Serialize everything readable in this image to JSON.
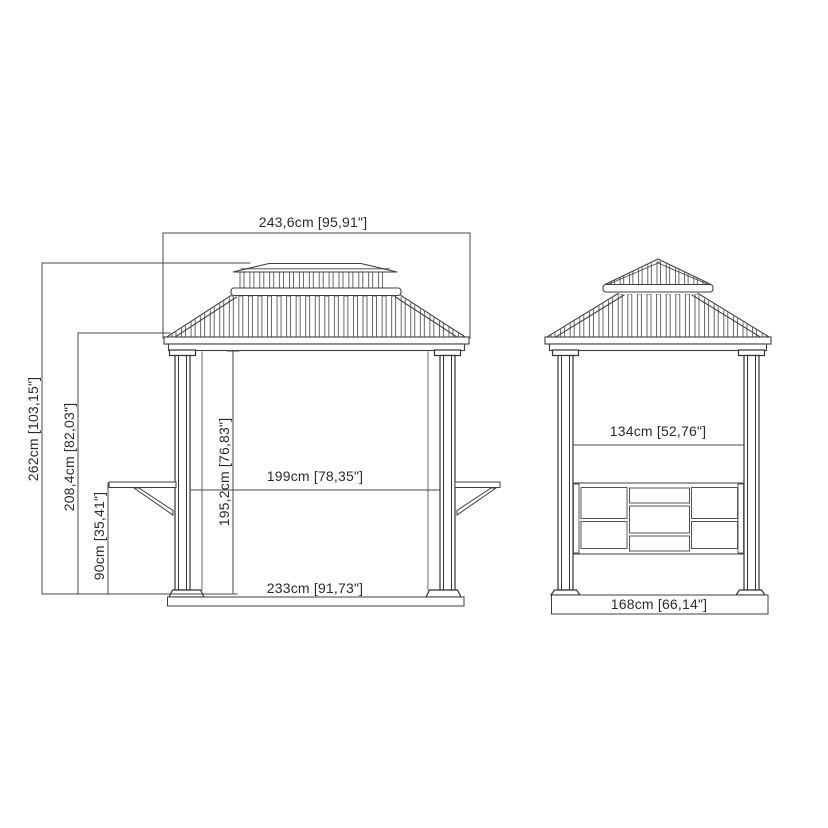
{
  "drawing_meta": {
    "background": "#ffffff",
    "line_color": "#474747",
    "text_color": "#2b2b2b"
  },
  "front_view": {
    "dims": {
      "roof_width": "243,6cm [95,91\"]",
      "total_height": "262cm [103,15\"]",
      "frame_height": "208,4cm [82,03\"]",
      "shelf_height": "90cm [35,41\"]",
      "post_clear_height": "195,2cm [76,83\"]",
      "inner_width": "199cm [78,35\"]",
      "base_width": "233cm [91,73\"]"
    }
  },
  "side_view": {
    "dims": {
      "inner_depth": "134cm [52,76\"]",
      "base_depth": "168cm [66,14\"]"
    }
  }
}
